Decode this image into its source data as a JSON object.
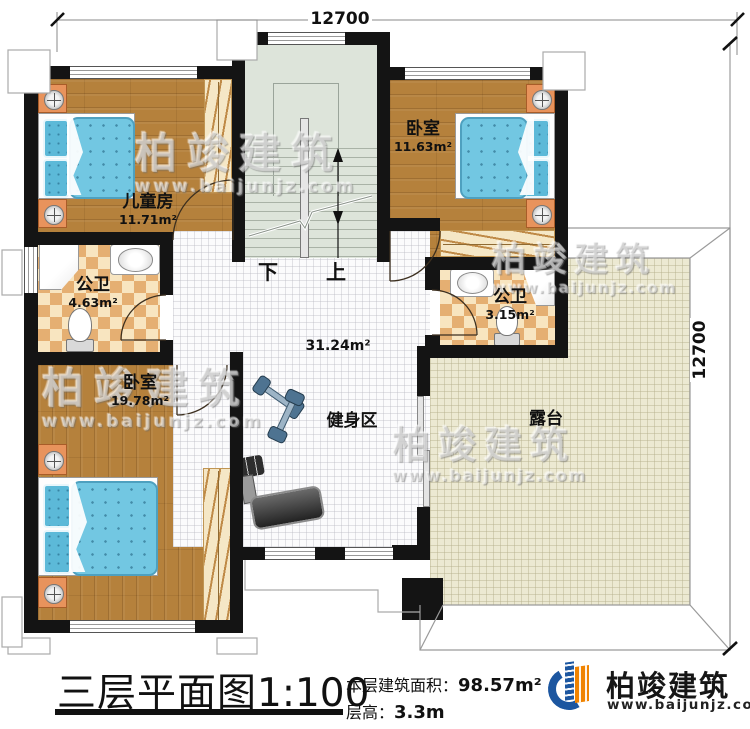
{
  "dimensions": {
    "top": "12700",
    "right": "12700"
  },
  "rooms": {
    "children": {
      "name": "儿童房",
      "area": "11.71m²"
    },
    "bedroom_tr": {
      "name": "卧室",
      "area": "11.63m²"
    },
    "bath_left": {
      "name": "公卫",
      "area": "4.63m²"
    },
    "bath_right": {
      "name": "公卫",
      "area": "3.15m²"
    },
    "bedroom_bl": {
      "name": "卧室",
      "area": "19.78m²"
    },
    "hall": {
      "area": "31.24m²"
    },
    "gym": {
      "name": "健身区"
    },
    "terrace": {
      "name": "露台"
    }
  },
  "stairs": {
    "down_label": "下",
    "up_label": "上"
  },
  "watermark": {
    "brand": "柏竣建筑",
    "url": "www.baijunjz.com"
  },
  "footer": {
    "title": "三层平面图",
    "scale": "1:100",
    "area_label": "本层建筑面积：",
    "area_value": "98.57m²",
    "height_label": "层高：",
    "height_value": "3.3m",
    "brand": "柏竣建筑",
    "brand_url": "www.baijunjz.com"
  },
  "colors": {
    "wall": "#141414",
    "wood": "#b5813c",
    "terrace_tile": "#ece9d2",
    "checker": "#e5af72",
    "mattress": "#72c7e2",
    "nightstand": "#e8935c",
    "stairwell": "#dde4da",
    "logo_blue": "#1c56a0",
    "logo_orange": "#f08300"
  }
}
